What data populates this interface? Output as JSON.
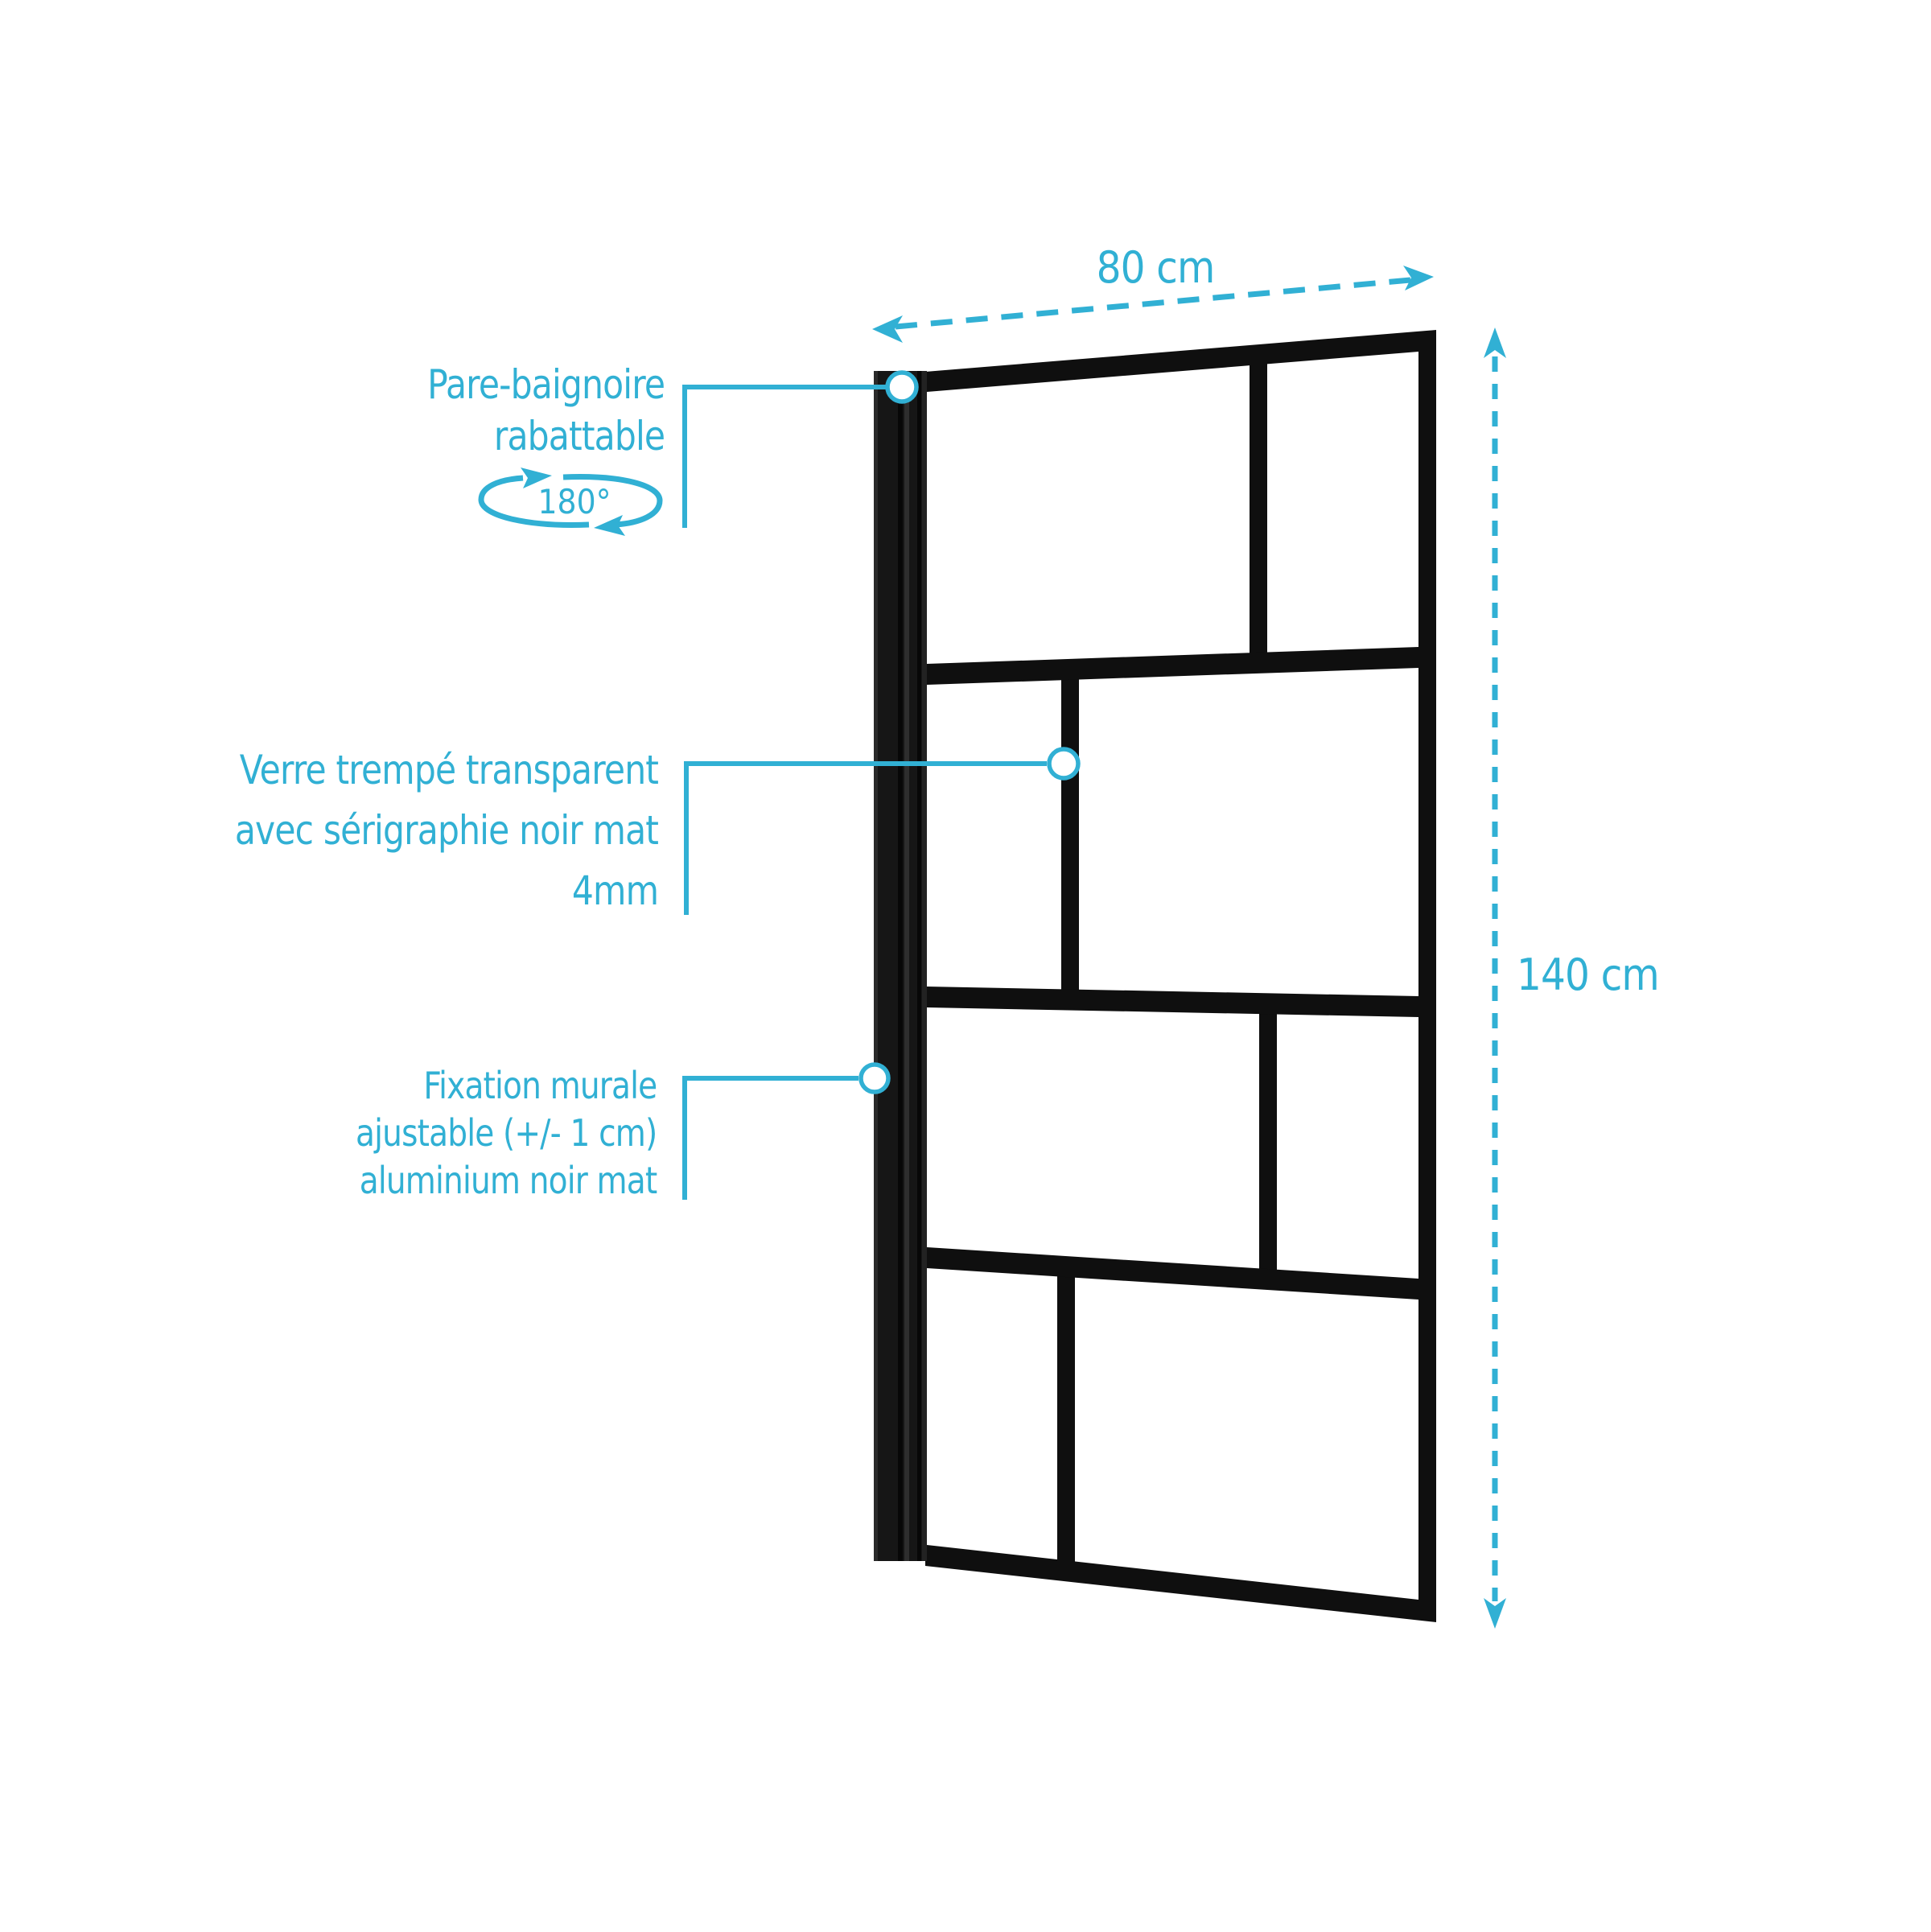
{
  "colors": {
    "accent": "#31b0d4",
    "frame_black": "#0f0f0f",
    "background": "#ffffff"
  },
  "dimensions": {
    "width_label": "80 cm",
    "height_label": "140 cm"
  },
  "rotation_badge": {
    "angle_label": "180°"
  },
  "annotations": {
    "foldable": {
      "line1": "Pare-baignoire",
      "line2": "rabattable"
    },
    "glass": {
      "line1": "Verre trempé transparent",
      "line2": "avec sérigraphie noir mat",
      "line3": "4mm"
    },
    "mount": {
      "line1": "Fixation murale",
      "line2": "ajustable (+/- 1 cm)",
      "line3": "aluminium noir mat"
    }
  }
}
